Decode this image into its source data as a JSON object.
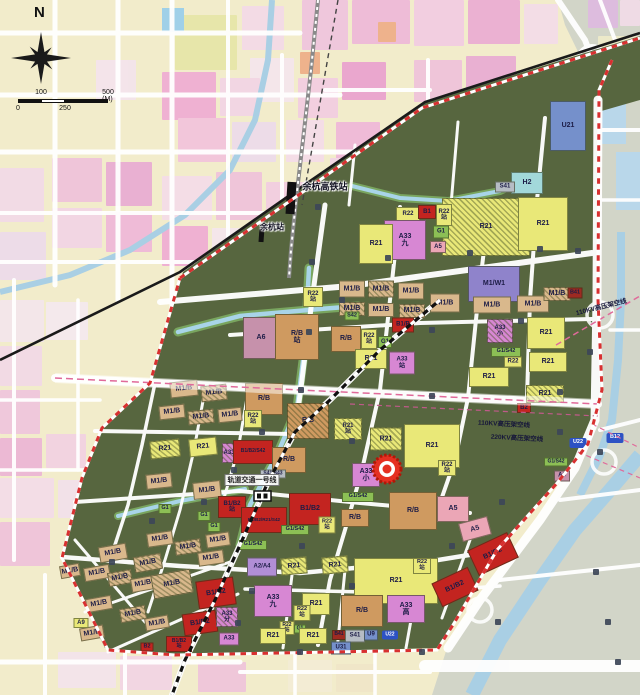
{
  "compass": {
    "north": "N"
  },
  "scalebar": {
    "t100": "100",
    "t500": "500 (M)",
    "t0": "0",
    "t250": "250"
  },
  "marker": {
    "color": "#e53022"
  },
  "palette": {
    "Y": "#e9e878",
    "M": "#d9b88c",
    "RB": "#cf9a60",
    "RED": "#c32420",
    "MA": "#d787d3",
    "PU": "#8f83cb",
    "A5": "#eba6b6",
    "A6": "#c691ab",
    "AP": "#b18ed6",
    "G": "#8cbf55",
    "U": "#7590cb",
    "H": "#a2d8da",
    "S": "#b6bcc4",
    "DR": "#9e2a22",
    "TB": "#2d52c4"
  },
  "labels": [
    {
      "t": "余杭高铁站",
      "x": 325,
      "y": 186,
      "f": 9,
      "halo": 1
    },
    {
      "t": "余杭站",
      "x": 272,
      "y": 227,
      "f": 8,
      "halo": 1
    },
    {
      "t": "轨道交通一号线",
      "x": 252,
      "y": 480,
      "f": 7,
      "bg": 1
    },
    {
      "t": "110KV高压架空线",
      "x": 601,
      "y": 306,
      "f": 6.5,
      "r": -14
    },
    {
      "t": "110KV高压架空线",
      "x": 504,
      "y": 423,
      "f": 6.5,
      "r": 3
    },
    {
      "t": "220KV高压架空线",
      "x": 517,
      "y": 437,
      "f": 6.5,
      "r": 3
    }
  ],
  "zones": [
    {
      "t": "U21",
      "x": 568,
      "y": 126,
      "w": 36,
      "h": 50,
      "c": "U"
    },
    {
      "t": "H2",
      "x": 527,
      "y": 183,
      "w": 32,
      "h": 22,
      "c": "H"
    },
    {
      "t": "S41",
      "x": 505,
      "y": 187,
      "w": 20,
      "h": 11,
      "c": "S",
      "f": 6
    },
    {
      "t": "R21",
      "x": 486,
      "y": 227,
      "w": 88,
      "h": 58,
      "c": "Y",
      "ha": 1
    },
    {
      "t": "R21",
      "x": 543,
      "y": 224,
      "w": 50,
      "h": 54,
      "c": "Y"
    },
    {
      "t": "R22",
      "x": 408,
      "y": 214,
      "w": 24,
      "h": 14,
      "c": "Y",
      "f": 6
    },
    {
      "t": "B1",
      "x": 427,
      "y": 212,
      "w": 18,
      "h": 14,
      "c": "RED",
      "f": 6
    },
    {
      "t": "R22\n站",
      "x": 444,
      "y": 215,
      "w": 16,
      "h": 22,
      "c": "Y",
      "f": 6
    },
    {
      "t": "G1",
      "x": 441,
      "y": 232,
      "w": 16,
      "h": 13,
      "c": "G",
      "f": 6
    },
    {
      "t": "A5",
      "x": 438,
      "y": 247,
      "w": 16,
      "h": 12,
      "c": "A5",
      "f": 6
    },
    {
      "t": "A33\n九",
      "x": 405,
      "y": 240,
      "w": 42,
      "h": 40,
      "c": "MA"
    },
    {
      "t": "R21",
      "x": 376,
      "y": 244,
      "w": 34,
      "h": 40,
      "c": "Y"
    },
    {
      "t": "M1/W1",
      "x": 494,
      "y": 284,
      "w": 52,
      "h": 36,
      "c": "PU"
    },
    {
      "t": "M1/B",
      "x": 352,
      "y": 289,
      "w": 26,
      "h": 17,
      "c": "M"
    },
    {
      "t": "M1/B",
      "x": 381,
      "y": 289,
      "w": 26,
      "h": 17,
      "c": "M",
      "ha": 1
    },
    {
      "t": "M1/B",
      "x": 411,
      "y": 291,
      "w": 26,
      "h": 17,
      "c": "M"
    },
    {
      "t": "M1/B",
      "x": 352,
      "y": 309,
      "w": 26,
      "h": 14,
      "c": "M",
      "ha": 1
    },
    {
      "t": "M1/B",
      "x": 381,
      "y": 310,
      "w": 26,
      "h": 14,
      "c": "M"
    },
    {
      "t": "M1/B",
      "x": 412,
      "y": 311,
      "w": 26,
      "h": 14,
      "c": "M",
      "ha": 1
    },
    {
      "t": "M1/B",
      "x": 445,
      "y": 303,
      "w": 30,
      "h": 19,
      "c": "M"
    },
    {
      "t": "M1/B",
      "x": 492,
      "y": 305,
      "w": 38,
      "h": 17,
      "c": "M"
    },
    {
      "t": "M1/B",
      "x": 533,
      "y": 304,
      "w": 32,
      "h": 17,
      "c": "M"
    },
    {
      "t": "M1/B",
      "x": 557,
      "y": 294,
      "w": 27,
      "h": 14,
      "c": "M",
      "ha": 1
    },
    {
      "t": "B41",
      "x": 575,
      "y": 293,
      "w": 15,
      "h": 11,
      "c": "DR",
      "f": 5.5
    },
    {
      "t": "S42",
      "x": 352,
      "y": 316,
      "w": 15,
      "h": 9,
      "c": "G",
      "f": 5.5
    },
    {
      "t": "A33\n小",
      "x": 500,
      "y": 331,
      "w": 26,
      "h": 24,
      "c": "MA",
      "ha": 1,
      "f": 6
    },
    {
      "t": "G1/S42",
      "x": 506,
      "y": 352,
      "w": 30,
      "h": 10,
      "c": "G",
      "f": 5.5
    },
    {
      "t": "R22",
      "x": 513,
      "y": 362,
      "w": 18,
      "h": 11,
      "c": "Y",
      "f": 6
    },
    {
      "t": "R21",
      "x": 546,
      "y": 333,
      "w": 38,
      "h": 32,
      "c": "Y"
    },
    {
      "t": "R21",
      "x": 548,
      "y": 362,
      "w": 38,
      "h": 20,
      "c": "Y"
    },
    {
      "t": "R21",
      "x": 489,
      "y": 377,
      "w": 40,
      "h": 20,
      "c": "Y"
    },
    {
      "t": "R21",
      "x": 545,
      "y": 394,
      "w": 38,
      "h": 18,
      "c": "Y",
      "ha": 1
    },
    {
      "t": "B2",
      "x": 524,
      "y": 408,
      "w": 14,
      "h": 10,
      "c": "RED",
      "f": 6
    },
    {
      "t": "R22\n站",
      "x": 313,
      "y": 297,
      "w": 20,
      "h": 20,
      "c": "Y",
      "f": 6
    },
    {
      "t": "A6",
      "x": 261,
      "y": 338,
      "w": 36,
      "h": 42,
      "c": "A6"
    },
    {
      "t": "R/B\n站",
      "x": 297,
      "y": 337,
      "w": 44,
      "h": 46,
      "c": "RB"
    },
    {
      "t": "R/B",
      "x": 346,
      "y": 339,
      "w": 30,
      "h": 26,
      "c": "RB"
    },
    {
      "t": "R22\n站",
      "x": 369,
      "y": 339,
      "w": 16,
      "h": 20,
      "c": "Y",
      "f": 6
    },
    {
      "t": "G1",
      "x": 385,
      "y": 342,
      "w": 14,
      "h": 12,
      "c": "G",
      "f": 6
    },
    {
      "t": "B1/B",
      "x": 403,
      "y": 325,
      "w": 22,
      "h": 15,
      "c": "RED",
      "f": 6
    },
    {
      "t": "R21",
      "x": 371,
      "y": 359,
      "w": 32,
      "h": 20,
      "c": "Y"
    },
    {
      "t": "A33\n站",
      "x": 402,
      "y": 363,
      "w": 26,
      "h": 23,
      "c": "MA",
      "f": 6
    },
    {
      "t": "M1/B",
      "x": 184,
      "y": 389,
      "w": 28,
      "h": 16,
      "c": "M",
      "r": -6
    },
    {
      "t": "M1/B",
      "x": 214,
      "y": 393,
      "w": 26,
      "h": 16,
      "c": "M",
      "ha": 1,
      "r": -6
    },
    {
      "t": "M1/B",
      "x": 172,
      "y": 412,
      "w": 26,
      "h": 14,
      "c": "M",
      "r": -6
    },
    {
      "t": "M1/B",
      "x": 201,
      "y": 417,
      "w": 26,
      "h": 14,
      "c": "M",
      "ha": 1,
      "r": -6
    },
    {
      "t": "M1/B",
      "x": 230,
      "y": 415,
      "w": 24,
      "h": 14,
      "c": "M",
      "r": -6
    },
    {
      "t": "R/B",
      "x": 264,
      "y": 399,
      "w": 38,
      "h": 32,
      "c": "RB"
    },
    {
      "t": "R22\n站",
      "x": 253,
      "y": 419,
      "w": 18,
      "h": 18,
      "c": "Y",
      "f": 6
    },
    {
      "t": "R/B",
      "x": 308,
      "y": 421,
      "w": 42,
      "h": 36,
      "c": "RB",
      "ha": 1
    },
    {
      "t": "R21\n站",
      "x": 348,
      "y": 429,
      "w": 28,
      "h": 22,
      "c": "Y",
      "ha": 1,
      "f": 6
    },
    {
      "t": "R21",
      "x": 386,
      "y": 439,
      "w": 32,
      "h": 23,
      "c": "Y",
      "ha": 1
    },
    {
      "t": "R21",
      "x": 432,
      "y": 446,
      "w": 56,
      "h": 44,
      "c": "Y"
    },
    {
      "t": "R22\n站",
      "x": 447,
      "y": 468,
      "w": 18,
      "h": 16,
      "c": "Y",
      "f": 6
    },
    {
      "t": "A33\n小",
      "x": 366,
      "y": 475,
      "w": 28,
      "h": 24,
      "c": "MA"
    },
    {
      "t": "G1/S42",
      "x": 358,
      "y": 497,
      "w": 32,
      "h": 10,
      "c": "G",
      "f": 5.5
    },
    {
      "t": "R/B",
      "x": 413,
      "y": 511,
      "w": 48,
      "h": 38,
      "c": "RB"
    },
    {
      "t": "A5",
      "x": 453,
      "y": 509,
      "w": 32,
      "h": 26,
      "c": "A5"
    },
    {
      "t": "R/B",
      "x": 355,
      "y": 518,
      "w": 28,
      "h": 18,
      "c": "RB"
    },
    {
      "t": "U22",
      "x": 578,
      "y": 443,
      "w": 17,
      "h": 10,
      "c": "TB",
      "f": 5.5,
      "tag": 1
    },
    {
      "t": "B12",
      "x": 615,
      "y": 438,
      "w": 17,
      "h": 10,
      "c": "TB",
      "f": 5.5,
      "tag": 1
    },
    {
      "t": "G1/S42",
      "x": 556,
      "y": 462,
      "w": 24,
      "h": 9,
      "c": "G",
      "f": 5
    },
    {
      "t": "A6",
      "x": 562,
      "y": 476,
      "w": 16,
      "h": 11,
      "c": "A6",
      "f": 6
    },
    {
      "t": "R21",
      "x": 165,
      "y": 449,
      "w": 30,
      "h": 18,
      "c": "Y",
      "ha": 1,
      "r": -6
    },
    {
      "t": "R21",
      "x": 203,
      "y": 447,
      "w": 28,
      "h": 18,
      "c": "Y",
      "r": -6
    },
    {
      "t": "A33",
      "x": 229,
      "y": 453,
      "w": 14,
      "h": 20,
      "c": "MA",
      "ha": 1,
      "f": 6
    },
    {
      "t": "B1/B2/S42",
      "x": 253,
      "y": 452,
      "w": 40,
      "h": 24,
      "c": "RED",
      "f": 5
    },
    {
      "t": "R/B",
      "x": 289,
      "y": 460,
      "w": 34,
      "h": 26,
      "c": "RB"
    },
    {
      "t": "S41/S43",
      "x": 273,
      "y": 474,
      "w": 26,
      "h": 9,
      "c": "S",
      "f": 5
    },
    {
      "t": "M1/B",
      "x": 159,
      "y": 481,
      "w": 26,
      "h": 15,
      "c": "M",
      "r": -6
    },
    {
      "t": "M1/B",
      "x": 207,
      "y": 490,
      "w": 28,
      "h": 17,
      "c": "M",
      "r": -6
    },
    {
      "t": "B1/B2\n站",
      "x": 232,
      "y": 507,
      "w": 28,
      "h": 22,
      "c": "RED",
      "f": 6
    },
    {
      "t": "B1/B2",
      "x": 310,
      "y": 509,
      "w": 42,
      "h": 32,
      "c": "RED"
    },
    {
      "t": "B1/B2/R21/S42",
      "x": 264,
      "y": 520,
      "w": 46,
      "h": 26,
      "c": "RED",
      "f": 4.6
    },
    {
      "t": "G1",
      "x": 165,
      "y": 509,
      "w": 13,
      "h": 10,
      "c": "G",
      "f": 5.5
    },
    {
      "t": "G1",
      "x": 204,
      "y": 516,
      "w": 13,
      "h": 10,
      "c": "G",
      "f": 5.5
    },
    {
      "t": "G1",
      "x": 214,
      "y": 527,
      "w": 13,
      "h": 10,
      "c": "G",
      "f": 5.5
    },
    {
      "t": "G1/S42",
      "x": 295,
      "y": 530,
      "w": 28,
      "h": 10,
      "c": "G",
      "f": 5.5
    },
    {
      "t": "R22\n站",
      "x": 327,
      "y": 525,
      "w": 17,
      "h": 17,
      "c": "Y",
      "f": 5.5
    },
    {
      "t": "M1/B",
      "x": 160,
      "y": 539,
      "w": 26,
      "h": 14,
      "c": "M",
      "r": -8
    },
    {
      "t": "M1/B",
      "x": 188,
      "y": 547,
      "w": 26,
      "h": 14,
      "c": "M",
      "ha": 1,
      "r": -8
    },
    {
      "t": "M1/B",
      "x": 218,
      "y": 540,
      "w": 24,
      "h": 14,
      "c": "M",
      "r": -8
    },
    {
      "t": "M1/B",
      "x": 211,
      "y": 558,
      "w": 26,
      "h": 14,
      "c": "M",
      "r": -8
    },
    {
      "t": "G1/S42",
      "x": 253,
      "y": 545,
      "w": 28,
      "h": 10,
      "c": "G",
      "f": 5.5
    },
    {
      "t": "A2/A4",
      "x": 262,
      "y": 567,
      "w": 30,
      "h": 19,
      "c": "AP",
      "f": 6
    },
    {
      "t": "R21",
      "x": 294,
      "y": 566,
      "w": 26,
      "h": 17,
      "c": "Y",
      "ha": 1,
      "r": -5
    },
    {
      "t": "R21",
      "x": 335,
      "y": 565,
      "w": 26,
      "h": 17,
      "c": "Y",
      "ha": 1,
      "r": -5
    },
    {
      "t": "R21",
      "x": 396,
      "y": 581,
      "w": 84,
      "h": 46,
      "c": "Y"
    },
    {
      "t": "R22\n站",
      "x": 422,
      "y": 566,
      "w": 18,
      "h": 16,
      "c": "Y",
      "f": 5.5
    },
    {
      "t": "M1/B",
      "x": 113,
      "y": 553,
      "w": 28,
      "h": 16,
      "c": "M",
      "r": -10
    },
    {
      "t": "M1/B",
      "x": 148,
      "y": 563,
      "w": 28,
      "h": 16,
      "c": "M",
      "ha": 1,
      "r": -10
    },
    {
      "t": "M1/B",
      "x": 97,
      "y": 573,
      "w": 26,
      "h": 14,
      "c": "M",
      "r": -10
    },
    {
      "t": "M1/B",
      "x": 120,
      "y": 578,
      "w": 24,
      "h": 14,
      "c": "M",
      "ha": 1,
      "r": -10
    },
    {
      "t": "M1/B",
      "x": 143,
      "y": 584,
      "w": 24,
      "h": 14,
      "c": "M",
      "r": -10
    },
    {
      "t": "M1/B",
      "x": 172,
      "y": 584,
      "w": 40,
      "h": 24,
      "c": "M",
      "ha": 1,
      "r": -10
    },
    {
      "t": "M1/B",
      "x": 99,
      "y": 604,
      "w": 26,
      "h": 14,
      "c": "M",
      "r": -10
    },
    {
      "t": "M1/B",
      "x": 133,
      "y": 614,
      "w": 26,
      "h": 14,
      "c": "M",
      "ha": 1,
      "r": -10
    },
    {
      "t": "M1/B",
      "x": 157,
      "y": 623,
      "w": 24,
      "h": 13,
      "c": "M",
      "r": -10
    },
    {
      "t": "M1/B",
      "x": 92,
      "y": 633,
      "w": 24,
      "h": 13,
      "c": "M",
      "r": -10
    },
    {
      "t": "M1/B",
      "x": 70,
      "y": 571,
      "w": 20,
      "h": 13,
      "c": "M",
      "r": -10
    },
    {
      "t": "A9",
      "x": 81,
      "y": 623,
      "w": 15,
      "h": 10,
      "c": "Y",
      "f": 6
    },
    {
      "t": "B1/B2",
      "x": 216,
      "y": 593,
      "w": 38,
      "h": 28,
      "c": "RED",
      "r": -8
    },
    {
      "t": "B1/B2",
      "x": 200,
      "y": 623,
      "w": 34,
      "h": 22,
      "c": "RED",
      "r": -8
    },
    {
      "t": "B1/B2\n站",
      "x": 179,
      "y": 644,
      "w": 26,
      "h": 16,
      "c": "RED",
      "f": 5
    },
    {
      "t": "B2",
      "x": 147,
      "y": 647,
      "w": 13,
      "h": 9,
      "c": "RED",
      "f": 5.5
    },
    {
      "t": "A33\n分",
      "x": 227,
      "y": 617,
      "w": 22,
      "h": 20,
      "c": "MA",
      "ha": 1,
      "f": 6
    },
    {
      "t": "A33",
      "x": 229,
      "y": 639,
      "w": 20,
      "h": 13,
      "c": "MA",
      "f": 6
    },
    {
      "t": "A33\n九",
      "x": 273,
      "y": 601,
      "w": 38,
      "h": 32,
      "c": "MA"
    },
    {
      "t": "R21",
      "x": 316,
      "y": 604,
      "w": 28,
      "h": 22,
      "c": "Y"
    },
    {
      "t": "R/B",
      "x": 362,
      "y": 611,
      "w": 42,
      "h": 32,
      "c": "RB"
    },
    {
      "t": "A33\n高",
      "x": 406,
      "y": 609,
      "w": 38,
      "h": 28,
      "c": "MA"
    },
    {
      "t": "R22\n站",
      "x": 302,
      "y": 613,
      "w": 17,
      "h": 16,
      "c": "Y",
      "f": 5.5
    },
    {
      "t": "R22\n站",
      "x": 287,
      "y": 628,
      "w": 15,
      "h": 14,
      "c": "Y",
      "f": 5
    },
    {
      "t": "G1",
      "x": 300,
      "y": 629,
      "w": 12,
      "h": 9,
      "c": "G",
      "f": 5
    },
    {
      "t": "R21",
      "x": 273,
      "y": 636,
      "w": 26,
      "h": 16,
      "c": "Y"
    },
    {
      "t": "R21",
      "x": 313,
      "y": 636,
      "w": 28,
      "h": 16,
      "c": "Y"
    },
    {
      "t": "B41",
      "x": 339,
      "y": 635,
      "w": 14,
      "h": 10,
      "c": "DR",
      "f": 5
    },
    {
      "t": "S41",
      "x": 355,
      "y": 636,
      "w": 20,
      "h": 13,
      "c": "S",
      "f": 6
    },
    {
      "t": "U9",
      "x": 371,
      "y": 635,
      "w": 14,
      "h": 11,
      "c": "U",
      "f": 6
    },
    {
      "t": "U22",
      "x": 390,
      "y": 635,
      "w": 16,
      "h": 9,
      "c": "TB",
      "f": 5,
      "tag": 1
    },
    {
      "t": "U31",
      "x": 341,
      "y": 648,
      "w": 20,
      "h": 13,
      "c": "U",
      "f": 6
    },
    {
      "t": "A5",
      "x": 475,
      "y": 529,
      "w": 30,
      "h": 19,
      "c": "A5",
      "r": -15
    },
    {
      "t": "B1/B2",
      "x": 493,
      "y": 554,
      "w": 44,
      "h": 28,
      "c": "RED",
      "r": -25
    },
    {
      "t": "B1/B2",
      "x": 455,
      "y": 587,
      "w": 40,
      "h": 26,
      "c": "RED",
      "r": -25
    }
  ]
}
